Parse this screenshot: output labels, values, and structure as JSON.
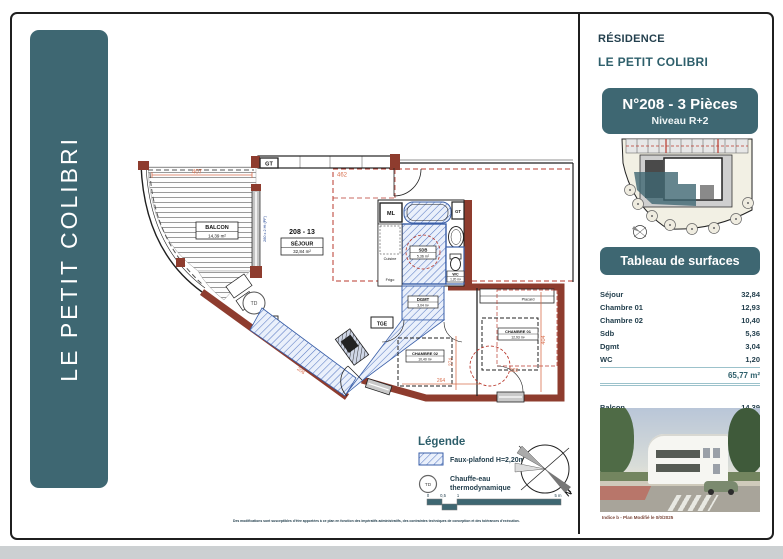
{
  "banner": {
    "text": "LE PETIT COLIBRI"
  },
  "header": {
    "residence_label": "RÉSIDENCE",
    "residence_name": "LE PETIT COLIBRI",
    "badge_title": "N°208 - 3 Pièces",
    "badge_subtitle": "Niveau R+2"
  },
  "surfaces": {
    "header": "Tableau de surfaces",
    "rows": [
      {
        "label": "Séjour",
        "value": "32,84"
      },
      {
        "label": "Chambre 01",
        "value": "12,93"
      },
      {
        "label": "Chambre 02",
        "value": "10,40"
      },
      {
        "label": "Sdb",
        "value": "5,36"
      },
      {
        "label": "Dgmt",
        "value": "3,04"
      },
      {
        "label": "WC",
        "value": "1,20"
      }
    ],
    "total": "65,77 m²",
    "balcon_label": "Balcon",
    "balcon_value": "14,39",
    "balcon_total": "14,39 m²"
  },
  "photo": {
    "caption": "Indice b - Plan Modifié le 0/0/2025"
  },
  "plan": {
    "unit_ref": "208 - 13",
    "sejour_name": "SÉJOUR",
    "sejour_area": "32,84 m²",
    "balcon_name": "BALCON",
    "balcon_area": "14,39 m²",
    "sdb_name": "SDB",
    "sdb_area": "5,36 m²",
    "wc_name": "WC",
    "wc_area": "1,20 m²",
    "dgmt_name": "DGMT",
    "dgmt_area": "3,04 m²",
    "ch1_name": "CHAMBRE 01",
    "ch1_area": "12,93 m²",
    "ch2_name": "CHAMBRE 02",
    "ch2_area": "10,40 m²",
    "gt": "GT",
    "ml": "ML",
    "td": "TD",
    "tge": "TGE",
    "cuisine": "Cuisine",
    "frigo": "Frigo",
    "placard": "Placard",
    "window_note": "260 x 2 Ht (PF)",
    "dims": {
      "d407": "407",
      "d462": "462",
      "d404": "404",
      "d302": "302",
      "d274": "274",
      "d264": "264",
      "d206": "206"
    }
  },
  "legend": {
    "title": "Légende",
    "item1": "Faux-plafond H=2,20m",
    "item2_line1": "Chauffe-eau",
    "item2_line2": "thermodynamique",
    "td": "TD",
    "north": "N",
    "scale": {
      "s0": "0",
      "s05": "0,5",
      "s1": "1",
      "s5": "5 m"
    }
  },
  "footer": {
    "disclaimer": "Des modifications sont susceptibles d'être apportées à ce plan en fonction des impératifs administratifs, des contraintes techniques de conception et des tolérances d'exécution."
  },
  "colors": {
    "teal": "#3E6772",
    "wall_red": "#8E3C2E",
    "hatch_blue": "#3A5FA8",
    "dash_red": "#B93A2E",
    "dim_orange": "#D96F4E"
  }
}
